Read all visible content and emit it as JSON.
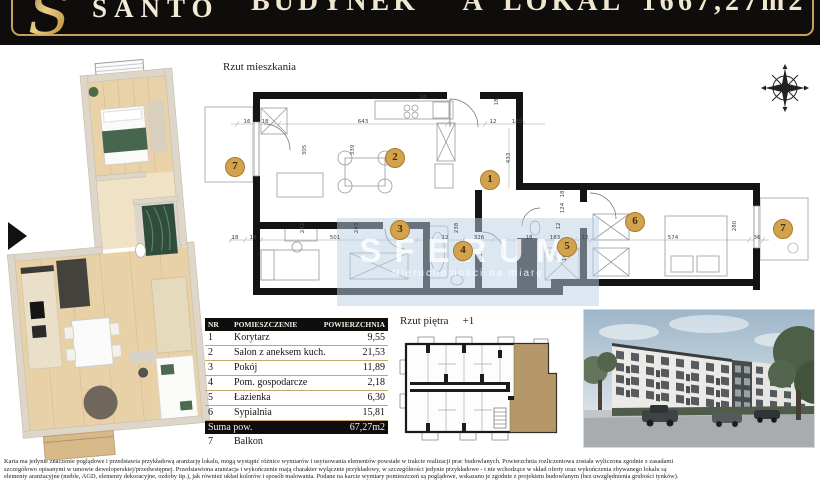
{
  "header": {
    "brand": "SANTO",
    "building": "BUDYNEK A",
    "unit": "LOKAL 16",
    "area": "67,27m2"
  },
  "plan": {
    "title": "Rzut mieszkania",
    "markers": [
      {
        "n": "1",
        "x": 295,
        "y": 122
      },
      {
        "n": "2",
        "x": 200,
        "y": 100
      },
      {
        "n": "3",
        "x": 205,
        "y": 172
      },
      {
        "n": "4",
        "x": 268,
        "y": 193
      },
      {
        "n": "5",
        "x": 372,
        "y": 189
      },
      {
        "n": "6",
        "x": 440,
        "y": 164
      },
      {
        "n": "7",
        "x": 40,
        "y": 109
      },
      {
        "n": "7",
        "x": 588,
        "y": 171
      }
    ],
    "dimensions": [
      {
        "t": "16",
        "x": 52,
        "y": 64
      },
      {
        "t": "18",
        "x": 70,
        "y": 64
      },
      {
        "t": "643",
        "x": 168,
        "y": 64
      },
      {
        "t": "12",
        "x": 298,
        "y": 64
      },
      {
        "t": "185",
        "x": 322,
        "y": 64
      },
      {
        "t": "433",
        "x": 314,
        "y": 100,
        "r": 1
      },
      {
        "t": "339",
        "x": 158,
        "y": 92,
        "r": 1
      },
      {
        "t": "305",
        "x": 110,
        "y": 92,
        "r": 1
      },
      {
        "t": "16",
        "x": 228,
        "y": 40
      },
      {
        "t": "18",
        "x": 302,
        "y": 44,
        "r": 1
      },
      {
        "t": "18",
        "x": 40,
        "y": 180
      },
      {
        "t": "18",
        "x": 58,
        "y": 180
      },
      {
        "t": "501",
        "x": 140,
        "y": 180
      },
      {
        "t": "243",
        "x": 162,
        "y": 170,
        "r": 1
      },
      {
        "t": "242",
        "x": 108,
        "y": 170,
        "r": 1
      },
      {
        "t": "12",
        "x": 250,
        "y": 180
      },
      {
        "t": "238",
        "x": 262,
        "y": 170,
        "r": 1
      },
      {
        "t": "326",
        "x": 284,
        "y": 180
      },
      {
        "t": "18",
        "x": 334,
        "y": 180
      },
      {
        "t": "183",
        "x": 360,
        "y": 180
      },
      {
        "t": "12",
        "x": 390,
        "y": 180
      },
      {
        "t": "574",
        "x": 478,
        "y": 180
      },
      {
        "t": "36",
        "x": 562,
        "y": 180
      },
      {
        "t": "280",
        "x": 540,
        "y": 168,
        "r": 1
      },
      {
        "t": "124",
        "x": 368,
        "y": 150,
        "r": 1
      },
      {
        "t": "12",
        "x": 364,
        "y": 168,
        "r": 1
      },
      {
        "t": "144",
        "x": 370,
        "y": 198,
        "r": 1
      },
      {
        "t": "18",
        "x": 368,
        "y": 136,
        "r": 1
      }
    ]
  },
  "watermark": {
    "brand": "SFERUM",
    "tagline": "Nieruchomości na miarę"
  },
  "table": {
    "headers": [
      "NR",
      "POMIESZCZENIE",
      "POWIERZCHNIA"
    ],
    "rows": [
      {
        "nr": "1",
        "name": "Korytarz",
        "area": "9,55"
      },
      {
        "nr": "2",
        "name": "Salon z aneksem kuch.",
        "area": "21,53"
      },
      {
        "nr": "3",
        "name": "Pokój",
        "area": "11,89"
      },
      {
        "nr": "4",
        "name": "Pom. gospodarcze",
        "area": "2,18"
      },
      {
        "nr": "5",
        "name": "Łazienka",
        "area": "6,30"
      },
      {
        "nr": "6",
        "name": "Sypialnia",
        "area": "15,81"
      }
    ],
    "total_label": "Suma pow.",
    "total_value": "67,27m2",
    "extra": {
      "nr": "7",
      "name": "Balkon"
    }
  },
  "floor_overview": {
    "title": "Rzut piętra",
    "level": "+1"
  },
  "disclaimer": {
    "line1": "Karta ma jedynie znaczenie poglądowe i przedstawia przykładową aranżację lokalu, mogą wystąpić różnice wymiarów i usytuowania elementów powstałe w trakcie realizacji prac budowlanych.  Powierzchnia rozliczeniowa została wyliczona zgodnie z zasadami",
    "line2": "szczegółowo opisanymi w umowie deweloperskiej/przedwstępnej. Przedstawiona aranżacja i wykończenie mają charakter wyłącznie przykładowy, w szczególności jedynie przykładowe - i nie wchodzące w skład oferty oraz wykończenia zbywanego lokalu są",
    "line3": "elementy aranżacyjne (meble, AGD, elementy dekoracyjne, ozdoby itp.), jak również układ kolorów i sposób malowania. Podane na karcie wymiary pomieszczeń są poglądowe, wskazano je zgodnie z projektem budowlanym (bez uwzględnienia grubości tynków)."
  },
  "colors": {
    "header_bg": "#0e0d0b",
    "gold": "#c9a05a",
    "marker": "#d2a24c",
    "table_line": "#c9a567",
    "apartment_highlight": "#b5986a",
    "watermark_bg": "#bacfe4"
  }
}
